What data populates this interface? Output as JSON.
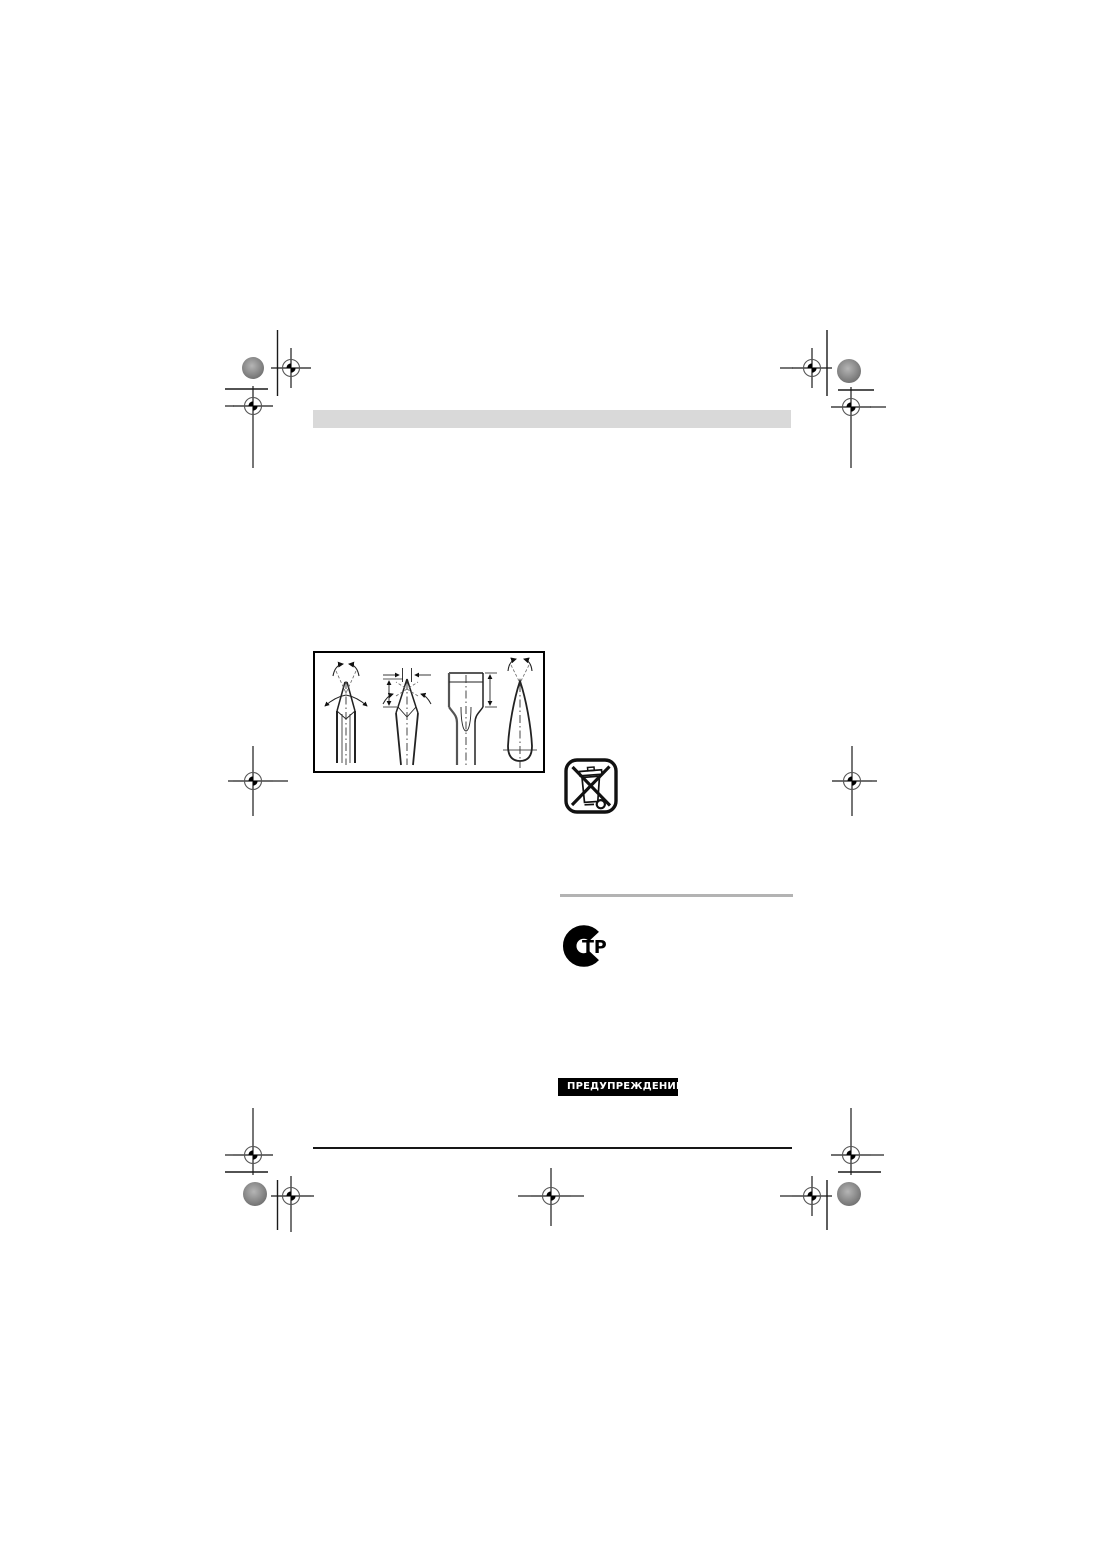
{
  "page": {
    "background_color": "#ffffff"
  },
  "decor": {
    "header_bar_color": "#d9d9d9",
    "gray_divider_color": "#b3b3b3",
    "black_rule_color": "#161616",
    "print_mark_color": "#1a1a1a",
    "halftone_dot_color": "#8a8a8a"
  },
  "icons": {
    "registration_target": "registration-target-icon",
    "halftone_dot": "halftone-dot-icon",
    "weee_symbol": "crossed-out-wheeled-bin-icon",
    "certification_mark": "rostest-str-certification-icon",
    "warning_triangle": "warning-triangle-icon",
    "figure": "chisel-sharpening-diagram"
  },
  "certification": {
    "label": "ТР"
  },
  "warning": {
    "label": "ПРЕДУПРЕЖДЕНИЕ",
    "background_color": "#000000",
    "text_color": "#ffffff"
  }
}
